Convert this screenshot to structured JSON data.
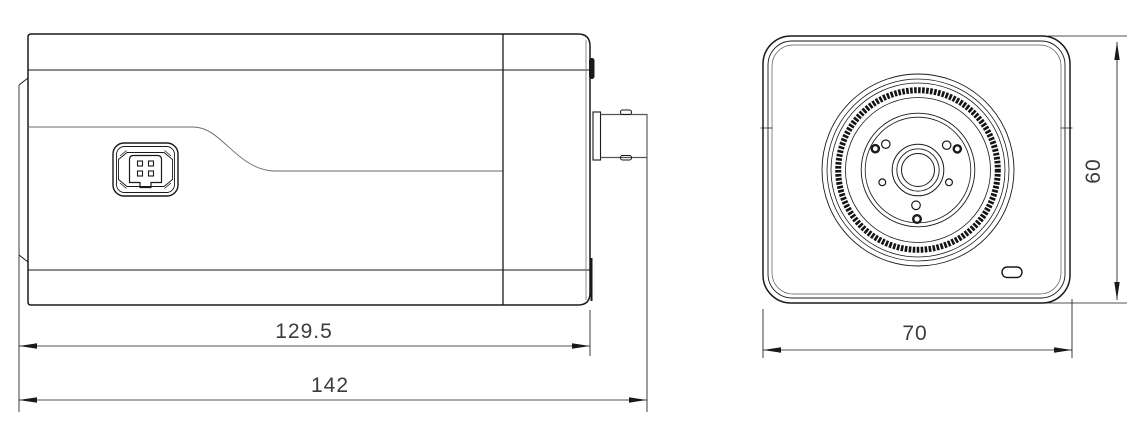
{
  "drawing": {
    "background": "#ffffff",
    "line_color": "#1a1a1a",
    "thin_line_color": "#6a6a6a",
    "side_view": {
      "dim_body_length": "129.5",
      "dim_total_length": "142"
    },
    "front_view": {
      "dim_width": "70",
      "dim_height": "60"
    }
  }
}
